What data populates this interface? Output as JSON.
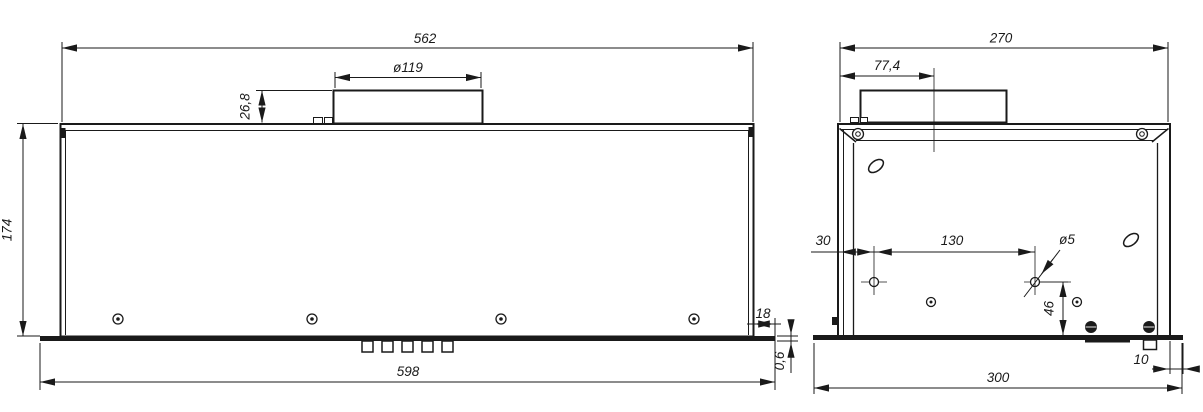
{
  "dims": {
    "front": {
      "overall_width": "562",
      "duct_diameter": "ø119",
      "duct_height": "26,8",
      "body_height": "174",
      "bottom_width": "598",
      "flange_overhang": "18",
      "sheet_thickness": "0,6"
    },
    "side": {
      "overall_depth": "270",
      "duct_center_offset": "77,4",
      "hole_edge_offset": "30",
      "hole_spacing": "130",
      "hole_diameter": "ø5",
      "hole_bottom_offset": "46",
      "flange_overhang": "10",
      "bottom_depth": "300"
    }
  },
  "colors": {
    "line": "#1a1a1a",
    "background": "#ffffff"
  }
}
